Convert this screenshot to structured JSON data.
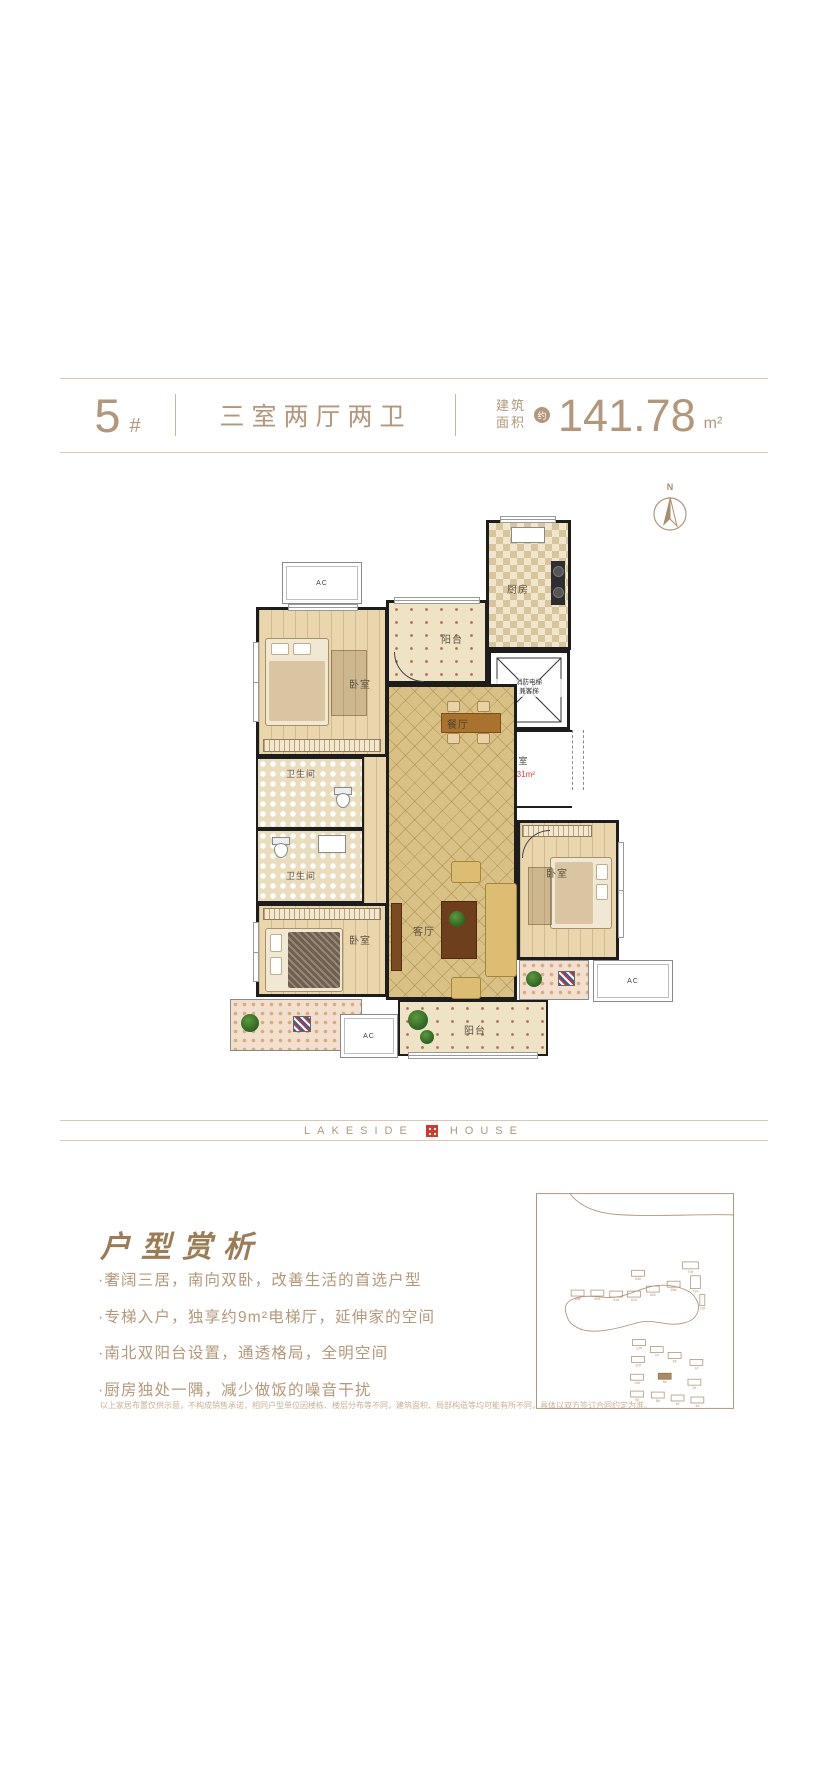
{
  "header": {
    "building_no": "5",
    "building_no_suffix": "#",
    "layout_name": "三室两厅两卫",
    "area_label_top": "建筑",
    "area_label_bottom": "面积",
    "area_approx_badge": "约",
    "area_value": "141.78",
    "area_unit": "m²"
  },
  "compass": {
    "north_label": "N"
  },
  "floorplan": {
    "bedroom1_label": "卧室",
    "bedroom2_label": "卧室",
    "bedroom3_label": "卧室",
    "bathroom1_label": "卫生间",
    "bathroom2_label": "卫生间",
    "kitchen_label": "厨房",
    "dining_label": "餐厅",
    "living_label": "客厅",
    "balcony_north_label": "阳台",
    "balcony_south_label": "阳台",
    "lobby_label": "前室",
    "lobby_area": "约9.31m²",
    "elevator_label_line1": "消防电梯",
    "elevator_label_line2": "兼客梯",
    "ac_label": "AC"
  },
  "brand": {
    "word_left": "LAKESIDE",
    "word_right": "HOUSE"
  },
  "analysis": {
    "title": "户型赏析",
    "bullets": [
      "·奢阔三居，南向双卧，改善生活的首选户型",
      "·专梯入户，独享约9m²电梯厅，延伸家的空间",
      "·南北双阳台设置，通透格局，全明空间",
      "·厨房独处一隅，减少做饭的噪音干扰"
    ],
    "disclaimer": "以上家居布置仅供示意，不构成销售承诺，相同户型单位因楼栋、楼层分布等不同，建筑面积、局部构造等均可能有所不同，具体以双方签订合同约定为准。"
  },
  "sitemap": {
    "highlighted_building": "5#",
    "buildings": [
      {
        "label": "64#",
        "x": 103,
        "y": 81
      },
      {
        "label": "70#",
        "x": 156,
        "y": 73,
        "w": 16,
        "h": 7
      },
      {
        "label": "30#",
        "x": 42,
        "y": 101
      },
      {
        "label": "60#",
        "x": 62,
        "y": 101
      },
      {
        "label": "51#",
        "x": 81,
        "y": 102
      },
      {
        "label": "61#",
        "x": 99,
        "y": 102
      },
      {
        "label": "62#",
        "x": 118,
        "y": 97
      },
      {
        "label": "65#",
        "x": 139,
        "y": 92
      },
      {
        "label": "71#",
        "x": 161,
        "y": 90,
        "w": 10,
        "h": 13
      },
      {
        "label": "72#",
        "x": 168,
        "y": 108,
        "w": 5,
        "h": 11
      },
      {
        "label": "12#",
        "x": 104,
        "y": 151
      },
      {
        "label": "7#",
        "x": 122,
        "y": 158
      },
      {
        "label": "6#",
        "x": 140,
        "y": 164
      },
      {
        "label": "11#",
        "x": 103,
        "y": 168
      },
      {
        "label": "1#",
        "x": 162,
        "y": 171
      },
      {
        "label": "10#",
        "x": 102,
        "y": 186
      },
      {
        "label": "5#",
        "x": 130,
        "y": 185,
        "filled": true
      },
      {
        "label": "2#",
        "x": 160,
        "y": 191
      },
      {
        "label": "9#",
        "x": 102,
        "y": 203
      },
      {
        "label": "8#",
        "x": 123,
        "y": 204
      },
      {
        "label": "4#",
        "x": 143,
        "y": 207
      },
      {
        "label": "3#",
        "x": 163,
        "y": 209
      }
    ]
  }
}
